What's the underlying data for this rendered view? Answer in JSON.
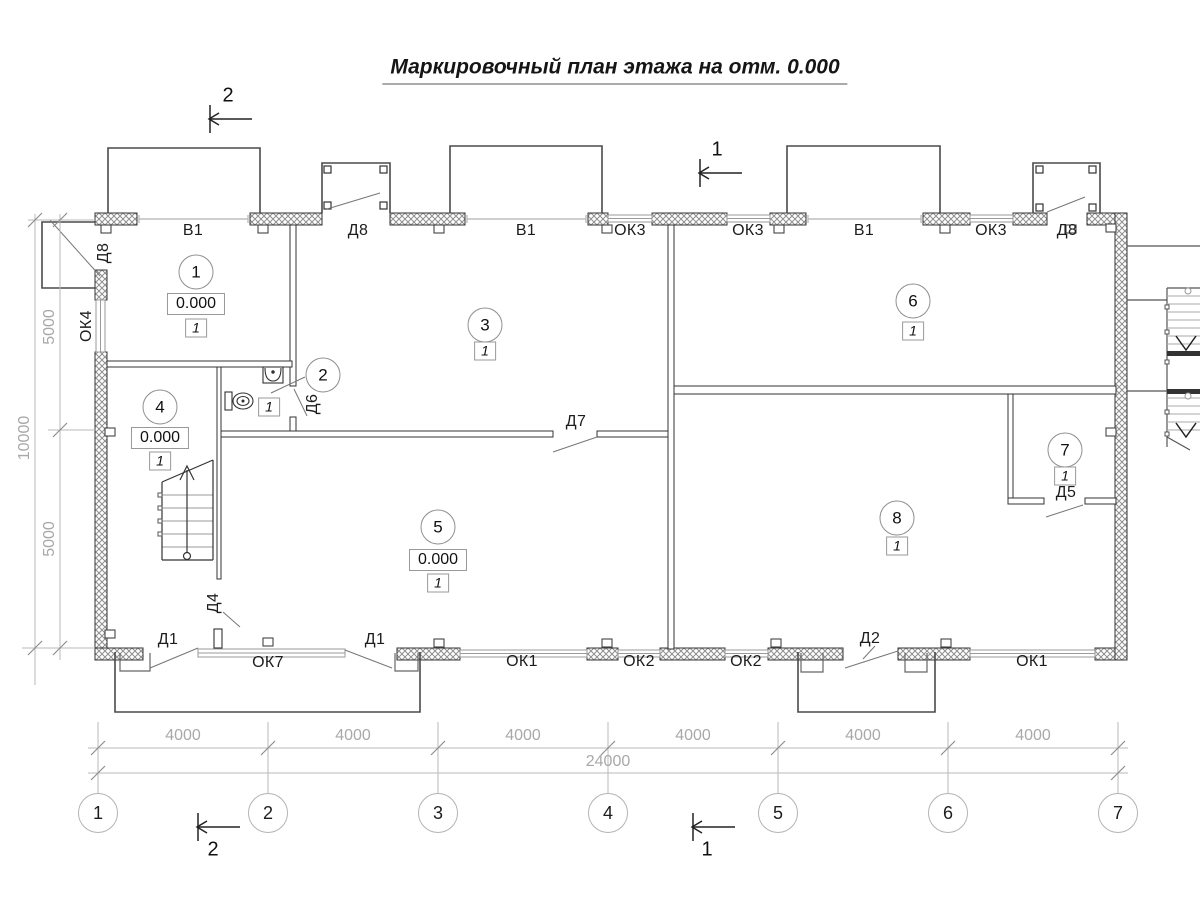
{
  "title": "Маркировочный план этажа на отм. 0.000",
  "sections": {
    "transverse": "2",
    "longitudinal": "1"
  },
  "axes": [
    "1",
    "2",
    "3",
    "4",
    "5",
    "6",
    "7"
  ],
  "dimensions": {
    "bay": "4000",
    "total": "24000",
    "left_bay": "5000",
    "left_total": "10000"
  },
  "wall_labels": {
    "top": [
      "В1",
      "Д8",
      "В1",
      "ОК3",
      "ОК3",
      "В1",
      "ОК3",
      "Д8"
    ],
    "left": [
      "Д8",
      "ОК4"
    ],
    "bottom": [
      "Д1",
      "ОК7",
      "Д1",
      "ОК1",
      "ОК2",
      "ОК2",
      "Д2",
      "ОК1"
    ],
    "interior": [
      "Д6",
      "Д7",
      "Д4",
      "Д5"
    ]
  },
  "rooms": [
    {
      "num": "1",
      "elevation": "0.000",
      "mark": "1"
    },
    {
      "num": "2",
      "mark": "1"
    },
    {
      "num": "3",
      "mark": "1"
    },
    {
      "num": "4",
      "elevation": "0.000",
      "mark": "1"
    },
    {
      "num": "5",
      "elevation": "0.000",
      "mark": "1"
    },
    {
      "num": "6",
      "mark": "1"
    },
    {
      "num": "7",
      "mark": "1"
    },
    {
      "num": "8",
      "mark": "1"
    }
  ],
  "colors": {
    "line": "#333333",
    "dim": "#a8a8a8",
    "background": "#ffffff"
  }
}
